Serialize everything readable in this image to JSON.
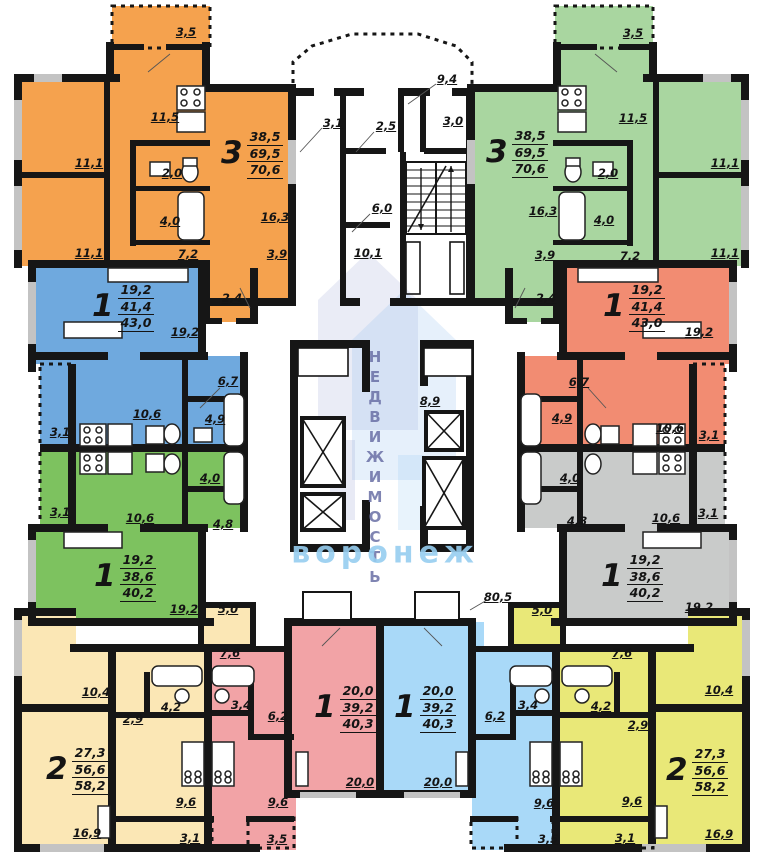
{
  "watermark": {
    "vertical": "НЕДВИЖИМОСТЬ",
    "horizontal": "воронеж"
  },
  "colors": {
    "orange": "#F5A24E",
    "green_top": "#A9D6A0",
    "blue_mid": "#6FA9DE",
    "salmon": "#F28C72",
    "green_mid": "#7DC25F",
    "gray_mid": "#C9CBCA",
    "cream": "#FBE7B5",
    "yellow": "#E9E878",
    "pink": "#F2A3A6",
    "blue_bottom": "#A9D9F8",
    "wall": "#161616"
  },
  "apartments": [
    {
      "id": "three-room-top-left",
      "rooms": "3",
      "stack": [
        "38,5",
        "69,5",
        "70,6"
      ],
      "x": 221,
      "y": 129
    },
    {
      "id": "three-room-top-right",
      "rooms": "3",
      "stack": [
        "38,5",
        "69,5",
        "70,6"
      ],
      "x": 486,
      "y": 128
    },
    {
      "id": "one-room-mid-left-upper",
      "rooms": "1",
      "stack": [
        "19,2",
        "41,4",
        "43,0"
      ],
      "x": 92,
      "y": 282
    },
    {
      "id": "one-room-mid-right-upper",
      "rooms": "1",
      "stack": [
        "19,2",
        "41,4",
        "43,0"
      ],
      "x": 603,
      "y": 282
    },
    {
      "id": "one-room-mid-left-lower",
      "rooms": "1",
      "stack": [
        "19,2",
        "38,6",
        "40,2"
      ],
      "x": 94,
      "y": 552
    },
    {
      "id": "one-room-mid-right-lower",
      "rooms": "1",
      "stack": [
        "19,2",
        "38,6",
        "40,2"
      ],
      "x": 601,
      "y": 552
    },
    {
      "id": "two-room-bottom-left",
      "rooms": "2",
      "stack": [
        "27,3",
        "56,6",
        "58,2"
      ],
      "x": 46,
      "y": 745
    },
    {
      "id": "two-room-bottom-right",
      "rooms": "2",
      "stack": [
        "27,3",
        "56,6",
        "58,2"
      ],
      "x": 666,
      "y": 746
    },
    {
      "id": "one-room-bottom-center-left",
      "rooms": "1",
      "stack": [
        "20,0",
        "39,2",
        "40,3"
      ],
      "x": 314,
      "y": 683
    },
    {
      "id": "one-room-bottom-center-right",
      "rooms": "1",
      "stack": [
        "20,0",
        "39,2",
        "40,3"
      ],
      "x": 394,
      "y": 683
    }
  ],
  "area_labels": [
    {
      "t": "3,5",
      "x": 186,
      "y": 32
    },
    {
      "t": "11,5",
      "x": 165,
      "y": 117
    },
    {
      "t": "11,1",
      "x": 89,
      "y": 163
    },
    {
      "t": "2,0",
      "x": 172,
      "y": 173
    },
    {
      "t": "4,0",
      "x": 170,
      "y": 221
    },
    {
      "t": "11,1",
      "x": 89,
      "y": 253
    },
    {
      "t": "7,2",
      "x": 188,
      "y": 254
    },
    {
      "t": "16,3",
      "x": 275,
      "y": 217
    },
    {
      "t": "3,9",
      "x": 277,
      "y": 254
    },
    {
      "t": "2,4",
      "x": 232,
      "y": 298
    },
    {
      "t": "3,5",
      "x": 633,
      "y": 33
    },
    {
      "t": "11,5",
      "x": 633,
      "y": 118
    },
    {
      "t": "11,1",
      "x": 725,
      "y": 163
    },
    {
      "t": "2,0",
      "x": 608,
      "y": 173
    },
    {
      "t": "4,0",
      "x": 604,
      "y": 220
    },
    {
      "t": "11,1",
      "x": 725,
      "y": 253
    },
    {
      "t": "7,2",
      "x": 630,
      "y": 256
    },
    {
      "t": "16,3",
      "x": 543,
      "y": 211
    },
    {
      "t": "3,9",
      "x": 545,
      "y": 255
    },
    {
      "t": "2,4",
      "x": 546,
      "y": 298
    },
    {
      "t": "9,4",
      "x": 447,
      "y": 79
    },
    {
      "t": "3,1",
      "x": 333,
      "y": 123
    },
    {
      "t": "2,5",
      "x": 386,
      "y": 126
    },
    {
      "t": "3,0",
      "x": 453,
      "y": 121
    },
    {
      "t": "6,0",
      "x": 382,
      "y": 208
    },
    {
      "t": "10,1",
      "x": 368,
      "y": 253
    },
    {
      "t": "8,9",
      "x": 430,
      "y": 401
    },
    {
      "t": "80,5",
      "x": 498,
      "y": 597
    },
    {
      "t": "19,2",
      "x": 185,
      "y": 332
    },
    {
      "t": "6,7",
      "x": 228,
      "y": 381
    },
    {
      "t": "10,6",
      "x": 147,
      "y": 414
    },
    {
      "t": "4,9",
      "x": 215,
      "y": 419
    },
    {
      "t": "3,1",
      "x": 60,
      "y": 432
    },
    {
      "t": "3,1",
      "x": 60,
      "y": 512
    },
    {
      "t": "10,6",
      "x": 140,
      "y": 518
    },
    {
      "t": "4,0",
      "x": 210,
      "y": 478
    },
    {
      "t": "4,8",
      "x": 223,
      "y": 524
    },
    {
      "t": "19,2",
      "x": 184,
      "y": 609
    },
    {
      "t": "19,2",
      "x": 699,
      "y": 332
    },
    {
      "t": "6,7",
      "x": 579,
      "y": 382
    },
    {
      "t": "10,6",
      "x": 670,
      "y": 428
    },
    {
      "t": "4,9",
      "x": 562,
      "y": 418
    },
    {
      "t": "3,1",
      "x": 709,
      "y": 435
    },
    {
      "t": "3,1",
      "x": 708,
      "y": 513
    },
    {
      "t": "10,6",
      "x": 666,
      "y": 518
    },
    {
      "t": "4,0",
      "x": 570,
      "y": 478
    },
    {
      "t": "4,8",
      "x": 577,
      "y": 521
    },
    {
      "t": "19,2",
      "x": 699,
      "y": 607
    },
    {
      "t": "5,0",
      "x": 228,
      "y": 609
    },
    {
      "t": "7,6",
      "x": 230,
      "y": 653
    },
    {
      "t": "10,4",
      "x": 96,
      "y": 692
    },
    {
      "t": "4,2",
      "x": 171,
      "y": 707
    },
    {
      "t": "2,9",
      "x": 133,
      "y": 719
    },
    {
      "t": "9,6",
      "x": 186,
      "y": 802
    },
    {
      "t": "16,9",
      "x": 87,
      "y": 833
    },
    {
      "t": "3,1",
      "x": 190,
      "y": 838
    },
    {
      "t": "3,4",
      "x": 241,
      "y": 705
    },
    {
      "t": "6,2",
      "x": 278,
      "y": 716
    },
    {
      "t": "9,6",
      "x": 278,
      "y": 802
    },
    {
      "t": "20,0",
      "x": 360,
      "y": 782
    },
    {
      "t": "3,5",
      "x": 277,
      "y": 839
    },
    {
      "t": "6,2",
      "x": 495,
      "y": 716
    },
    {
      "t": "3,4",
      "x": 528,
      "y": 705
    },
    {
      "t": "9,6",
      "x": 544,
      "y": 803
    },
    {
      "t": "20,0",
      "x": 438,
      "y": 782
    },
    {
      "t": "3,5",
      "x": 548,
      "y": 839
    },
    {
      "t": "5,0",
      "x": 542,
      "y": 610
    },
    {
      "t": "7,6",
      "x": 622,
      "y": 653
    },
    {
      "t": "10,4",
      "x": 719,
      "y": 690
    },
    {
      "t": "4,2",
      "x": 601,
      "y": 706
    },
    {
      "t": "2,9",
      "x": 638,
      "y": 725
    },
    {
      "t": "9,6",
      "x": 632,
      "y": 801
    },
    {
      "t": "16,9",
      "x": 719,
      "y": 834
    },
    {
      "t": "3,1",
      "x": 625,
      "y": 838
    }
  ]
}
